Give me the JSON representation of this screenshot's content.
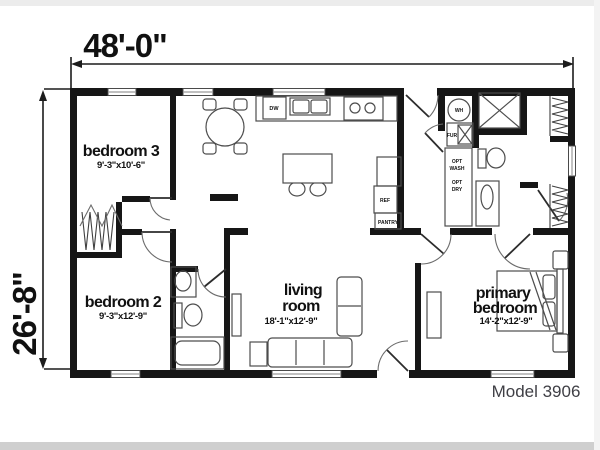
{
  "dims": {
    "width": "48'-0\"",
    "height": "26'-8\""
  },
  "rooms": {
    "bedroom3": {
      "name": "bedroom 3",
      "size": "9'-3\"x10'-6\""
    },
    "bedroom2": {
      "name": "bedroom 2",
      "size": "9'-3\"x12'-9\""
    },
    "living": {
      "name1": "living",
      "name2": "room",
      "size": "18'-1\"x12'-9\""
    },
    "primary": {
      "name1": "primary",
      "name2": "bedroom",
      "size": "14'-2\"x12'-9\""
    }
  },
  "labels": {
    "wh": "WH",
    "fur": "FUR",
    "ref": "REF",
    "pantry": "PANTRY",
    "dw": "DW",
    "opt1": "OPT",
    "wash": "WASH",
    "opt2": "OPT",
    "dry": "DRY"
  },
  "model": "Model 3906",
  "colors": {
    "wall": "#161616",
    "fixture_line": "#4d4d4d",
    "dimension": "#1c1c1c",
    "model_text": "#3f3f45",
    "background": "#ffffff"
  }
}
